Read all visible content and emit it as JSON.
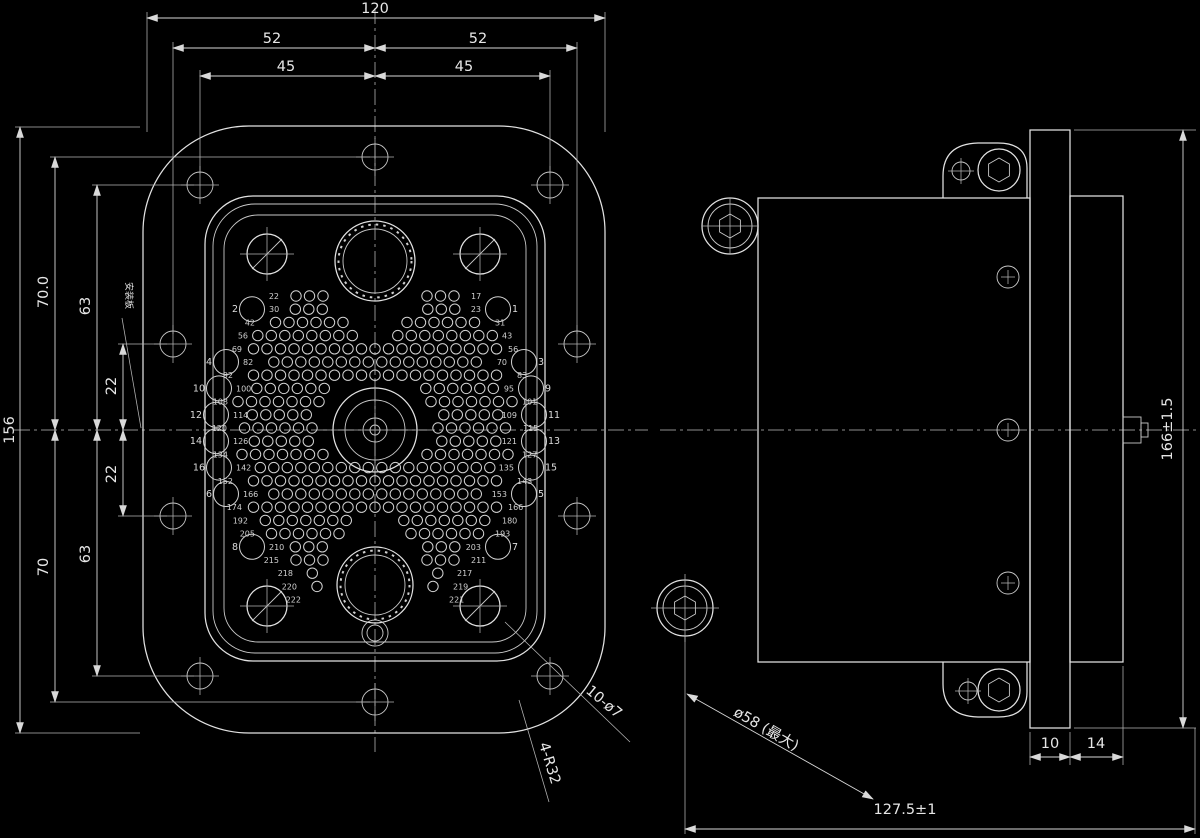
{
  "drawing": {
    "kind": "connector outline technical drawing",
    "views": [
      "front",
      "side"
    ]
  },
  "front_view": {
    "dimensions": {
      "width": "120",
      "span_52": "52",
      "span_45": "45",
      "height": "156",
      "top_70": "70.0",
      "top_63": "63",
      "top_22": "22",
      "bot_22": "22",
      "bot_63": "63",
      "bot_70": "70"
    },
    "callouts": {
      "holes": "10-ø7",
      "radius": "4-R32",
      "panel": "安装板"
    },
    "pin_field": {
      "center_x": 375,
      "start_y": 296,
      "row_spacing": 13.2,
      "pitch": 13.5,
      "pin_r": 5.2,
      "rows": [
        {
          "half": 88,
          "gap": 46,
          "l": "22",
          "r": "17"
        },
        {
          "half": 104,
          "gap": 40,
          "l": "30",
          "r": "23",
          "bl": "2",
          "br": "1"
        },
        {
          "half": 112,
          "gap": 26,
          "l": "42",
          "r": "31"
        },
        {
          "half": 119,
          "gap": 10,
          "l": "56",
          "r": "43"
        },
        {
          "half": 125,
          "gap": 0,
          "l": "69",
          "r": "56"
        },
        {
          "half": 130,
          "gap": 0,
          "l": "82",
          "r": "70",
          "bl": "4",
          "br": "3"
        },
        {
          "half": 134,
          "gap": 0,
          "l": "92",
          "r": "83"
        },
        {
          "half": 137,
          "gap": 38,
          "l": "100",
          "r": "95",
          "bl": "10",
          "br": "9"
        },
        {
          "half": 139,
          "gap": 50,
          "l": "108",
          "r": "101"
        },
        {
          "half": 140,
          "gap": 56,
          "l": "114",
          "r": "109",
          "bl": "12",
          "br": "11"
        },
        {
          "half": 140,
          "gap": 57,
          "l": "120",
          "r": "115"
        },
        {
          "half": 140,
          "gap": 54,
          "l": "126",
          "r": "121",
          "bl": "14",
          "br": "13"
        },
        {
          "half": 139,
          "gap": 46,
          "l": "134",
          "r": "127"
        },
        {
          "half": 137,
          "gap": 0,
          "l": "142",
          "r": "135",
          "bl": "16",
          "br": "15"
        },
        {
          "half": 134,
          "gap": 0,
          "l": "152",
          "r": "143"
        },
        {
          "half": 130,
          "gap": 0,
          "l": "166",
          "r": "153",
          "bl": "6",
          "br": "5"
        },
        {
          "half": 125,
          "gap": 0,
          "l": "174",
          "r": "166"
        },
        {
          "half": 119,
          "gap": 16,
          "l": "192",
          "r": "180"
        },
        {
          "half": 112,
          "gap": 30,
          "l": "205",
          "r": "193"
        },
        {
          "half": 104,
          "gap": 40,
          "l": "210",
          "r": "203",
          "bl": "8",
          "br": "7"
        },
        {
          "half": 88,
          "gap": 46,
          "l": "215",
          "r": "211"
        },
        {
          "half": 74,
          "gap": 50,
          "l": "218",
          "r": "217"
        },
        {
          "half": 70,
          "gap": 52,
          "l": "220",
          "r": "219"
        },
        {
          "half": 66,
          "gap": 54,
          "l": "222",
          "r": "221"
        }
      ]
    }
  },
  "side_view": {
    "dimensions": {
      "height": "166±1.5",
      "flange_thickness": "10",
      "shell_depth": "14",
      "overall_length": "127.5±1",
      "bend_diameter": "ø58 (最大)"
    }
  }
}
